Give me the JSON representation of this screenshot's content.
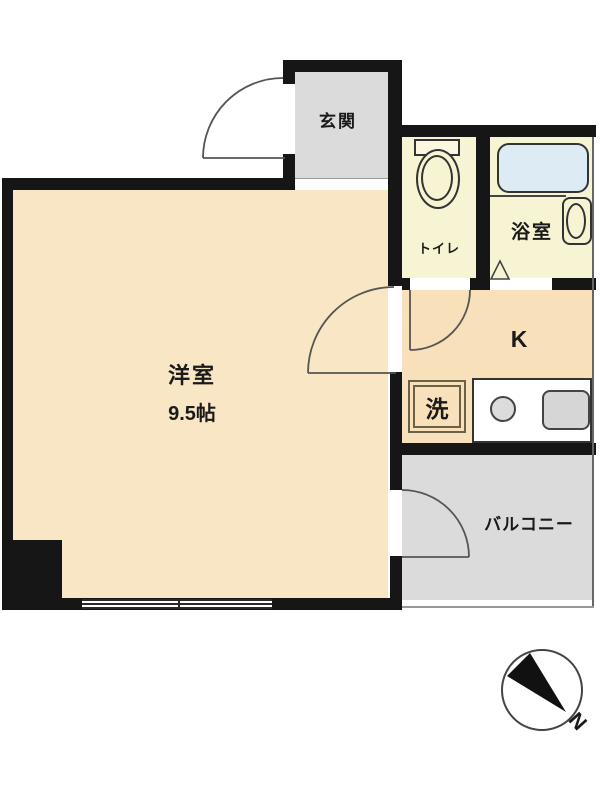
{
  "floorplan": {
    "rooms": {
      "entrance": {
        "label": "玄関"
      },
      "toilet": {
        "label": "トイレ"
      },
      "bathroom": {
        "label": "浴室"
      },
      "western_room": {
        "label": "洋室",
        "size": "9.5帖"
      },
      "kitchen": {
        "label": "K"
      },
      "washer": {
        "label": "洗"
      },
      "balcony": {
        "label": "バルコニー"
      }
    },
    "compass": {
      "north_label": "N"
    },
    "colors": {
      "wall": "#161616",
      "western_room_fill": "#F9E6C5",
      "kitchen_fill": "#F8E0BA",
      "wet_area_fill": "#F7F4D4",
      "gray_area_fill": "#DBDBDB",
      "bathtub_fill": "#DCEBF4",
      "fixture_gray": "#D6D6D6"
    }
  }
}
